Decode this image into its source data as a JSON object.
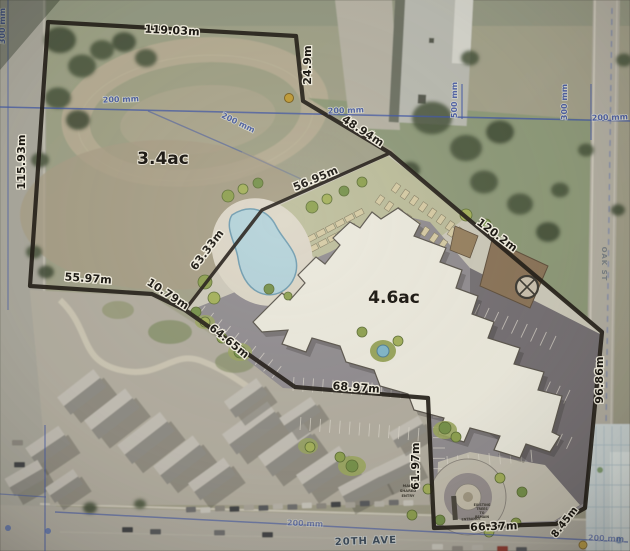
{
  "map": {
    "title": "Aerial site plan with parcel survey measurements",
    "parcels": {
      "left_area": "3.4ac",
      "right_area": "4.6ac"
    },
    "dimensions": {
      "d119": "119.03m",
      "d24": "24.9m",
      "d48": "48.94m",
      "d56": "56.95m",
      "d63": "63.33m",
      "d120": "120.2m",
      "d115": "115.93m",
      "d55": "55.97m",
      "d10": "10.79m",
      "d64": "64.65m",
      "d68": "68.97m",
      "d61": "61.97m",
      "d66": "66.37m",
      "d8": "8.45m",
      "d96": "96.86m"
    },
    "utilities": {
      "w200": "200 mm",
      "w500": "500 mm",
      "w300": "300 mm"
    },
    "streets": {
      "ave": "20TH AVE",
      "oak": "OAK ST"
    },
    "notes": {
      "entrance": "ENTRANCE",
      "main_entry_1": "MAIN",
      "main_entry_2": "SHARED",
      "main_entry_3": "ENTRY",
      "trees_1": "EXISTING",
      "trees_2": "TREES",
      "trees_3": "TO",
      "trees_4": "REMAIN"
    },
    "colors": {
      "boundary": "#201b15",
      "utility_blue": "#3f55a6",
      "pool_water": "#b3d2da",
      "pavement": "#908c90",
      "survey_marker": "#bf9a33"
    }
  }
}
